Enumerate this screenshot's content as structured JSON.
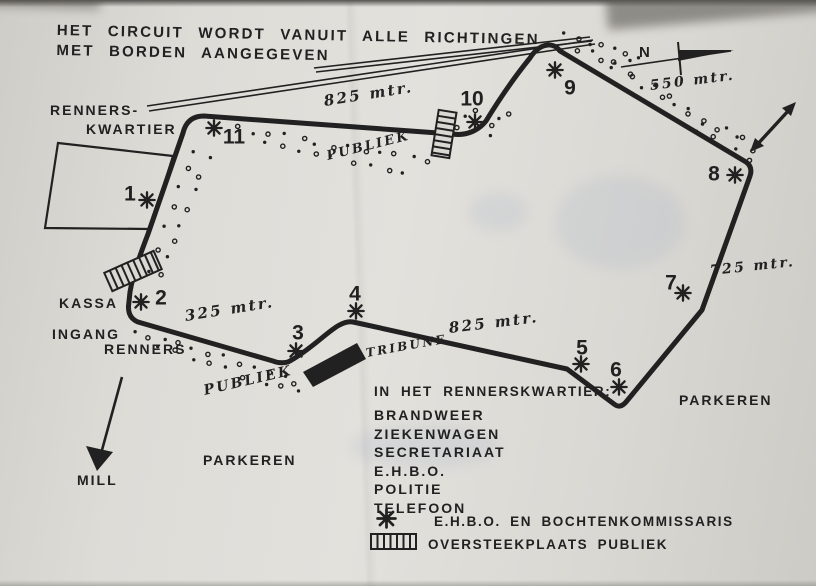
{
  "colors": {
    "paper": "#dad8d3",
    "ink": "#212121"
  },
  "title": {
    "line1": "HET CIRCUIT WORDT VANUIT ALLE RICHTINGEN",
    "line2": "MET BORDEN AANGEGEVEN"
  },
  "map": {
    "labels": [
      {
        "name": "renners-kwartier-label-line1",
        "text": "RENNERS-",
        "x": 50,
        "y": 103,
        "size": 14
      },
      {
        "name": "renners-kwartier-label-line2",
        "text": "KWARTIER",
        "x": 86,
        "y": 122,
        "size": 14
      },
      {
        "name": "kassa-label",
        "text": "KASSA",
        "x": 59,
        "y": 296,
        "size": 14
      },
      {
        "name": "ingang-renners-label-line1",
        "text": "INGANG",
        "x": 52,
        "y": 327,
        "size": 14
      },
      {
        "name": "ingang-renners-label-line2",
        "text": "RENNERS",
        "x": 104,
        "y": 342,
        "size": 14
      },
      {
        "name": "parkeren-left-label",
        "text": "PARKEREN",
        "x": 203,
        "y": 453,
        "size": 14
      },
      {
        "name": "parkeren-right-label",
        "text": "PARKEREN",
        "x": 679,
        "y": 393,
        "size": 14
      },
      {
        "name": "mill-label",
        "text": "MILL",
        "x": 77,
        "y": 473,
        "size": 14
      },
      {
        "name": "compass-n-label",
        "text": "N",
        "x": 639,
        "y": 45,
        "size": 15
      }
    ],
    "handwritten": [
      {
        "name": "distance-825-top",
        "text": "825 mtr.",
        "x": 324,
        "y": 94,
        "rot": -9,
        "size": 15
      },
      {
        "name": "distance-550",
        "text": "550 mtr.",
        "x": 650,
        "y": 79,
        "rot": -7,
        "size": 14
      },
      {
        "name": "distance-725",
        "text": "725 mtr.",
        "x": 710,
        "y": 264,
        "rot": -6,
        "size": 14
      },
      {
        "name": "distance-325",
        "text": "325 mtr.",
        "x": 185,
        "y": 309,
        "rot": -9,
        "size": 15
      },
      {
        "name": "distance-825-bottom",
        "text": "825 mtr.",
        "x": 449,
        "y": 321,
        "rot": -7,
        "size": 15
      },
      {
        "name": "publiek-top-label",
        "text": "PUBLIEK",
        "x": 327,
        "y": 150,
        "rot": -14,
        "size": 13
      },
      {
        "name": "publiek-bottom-label",
        "text": "PUBLIEK",
        "x": 204,
        "y": 384,
        "rot": -13,
        "size": 14
      },
      {
        "name": "tribune-label",
        "text": "TRIBUNE",
        "x": 366,
        "y": 347,
        "rot": -10,
        "size": 12
      }
    ],
    "markers": [
      {
        "n": "1",
        "star": [
          147,
          200
        ],
        "num": [
          130,
          194
        ]
      },
      {
        "n": "2",
        "star": [
          141,
          302
        ],
        "num": [
          161,
          298
        ]
      },
      {
        "n": "3",
        "star": [
          296,
          351
        ],
        "num": [
          298,
          333
        ]
      },
      {
        "n": "4",
        "star": [
          356,
          311
        ],
        "num": [
          355,
          294
        ]
      },
      {
        "n": "5",
        "star": [
          581,
          364
        ],
        "num": [
          582,
          348
        ]
      },
      {
        "n": "6",
        "star": [
          619,
          387
        ],
        "num": [
          616,
          370
        ]
      },
      {
        "n": "7",
        "star": [
          683,
          293
        ],
        "num": [
          671,
          283
        ]
      },
      {
        "n": "8",
        "star": [
          735,
          175
        ],
        "num": [
          714,
          174
        ]
      },
      {
        "n": "9",
        "star": [
          555,
          70
        ],
        "num": [
          570,
          88
        ]
      },
      {
        "n": "10",
        "star": [
          475,
          122
        ],
        "num": [
          472,
          99
        ]
      },
      {
        "n": "11",
        "star": [
          214,
          128
        ],
        "num": [
          234,
          137
        ]
      }
    ]
  },
  "legend": {
    "heading": "IN HET RENNERSKWARTIER:",
    "facilities": [
      "BRANDWEER",
      "ZIEKENWAGEN",
      "SECRETARIAAT",
      "E.H.B.O.",
      "POLITIE",
      "TELEFOON"
    ],
    "symbol_items": [
      {
        "symbol": "star",
        "text": "E.H.B.O. EN BOCHTENKOMMISSARIS"
      },
      {
        "symbol": "crossing",
        "text": "OVERSTEEKPLAATS PUBLIEK"
      }
    ]
  }
}
